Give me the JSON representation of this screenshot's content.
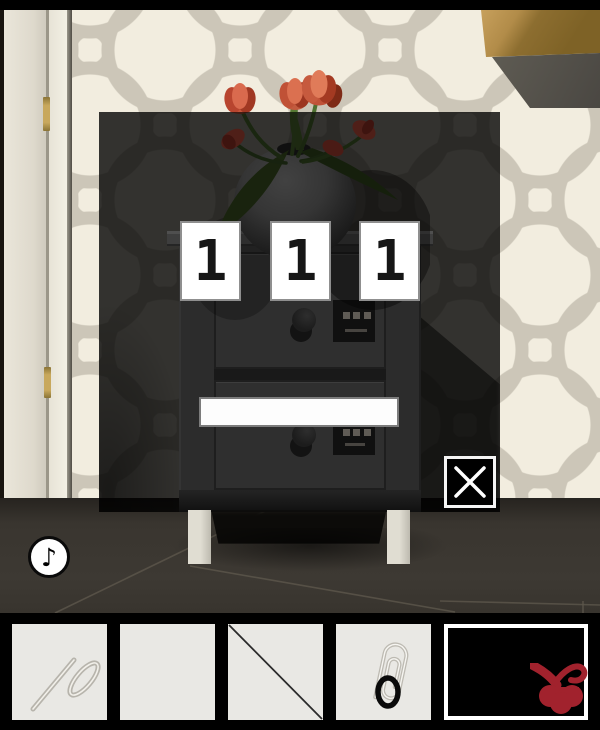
{
  "puzzle_panel": {
    "digits": [
      "1",
      "1",
      "1"
    ],
    "answer_bar": {
      "value": ""
    },
    "close_icon": "x-mark"
  },
  "hud": {
    "music_icon_glyph": "♪"
  },
  "inventory": {
    "slots": [
      {
        "name": "straightened-paperclip"
      },
      {
        "name": "empty"
      },
      {
        "name": "empty-with-diagonal"
      },
      {
        "name": "paperclip-with-ring"
      },
      {
        "name": "item-preview-tulip"
      }
    ]
  },
  "colors": {
    "accent_red": "#a1222d",
    "tulip_red": "#cc5540",
    "wall_cream": "#f2eddf",
    "pattern_gray": "#ccc6b8",
    "wood_tan": "#c7a05c",
    "floor_dark": "#39352f",
    "overlay": "rgba(0,0,0,0.79)",
    "slot_bg": "#e9e8e4"
  }
}
